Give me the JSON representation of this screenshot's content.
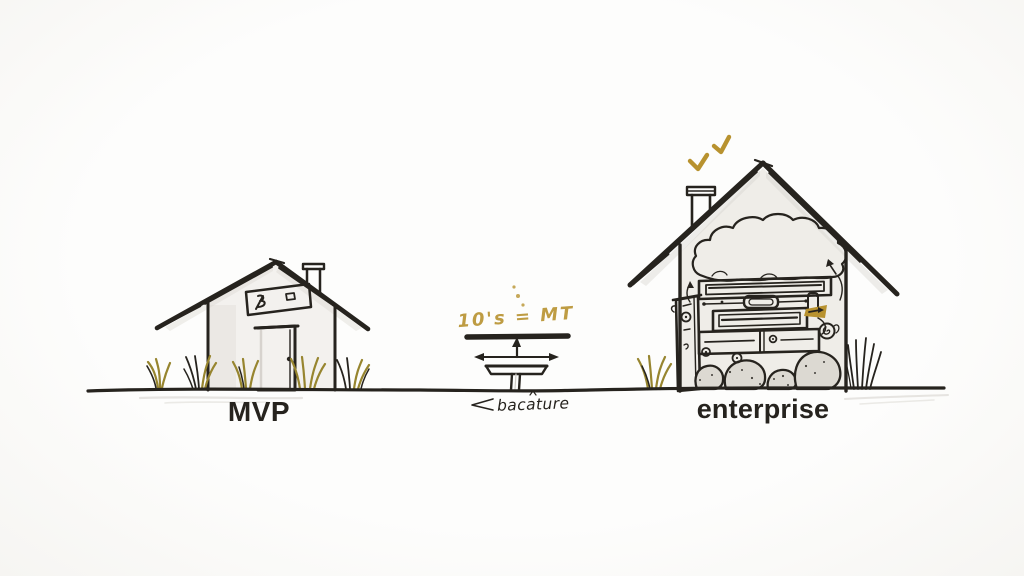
{
  "labels": {
    "mvp": "MVP",
    "enterprise": "enterprise",
    "pedestal_caption": "bacature",
    "pedestal_gold_note": "10's = MT"
  },
  "colors": {
    "ink": "#26231e",
    "paper": "#fcfcfa",
    "gold": "#b8922f",
    "olive": "#97852f",
    "wash": "#ebe8e2",
    "rock": "#dcd9d2",
    "shadow": "#cfccc6"
  }
}
